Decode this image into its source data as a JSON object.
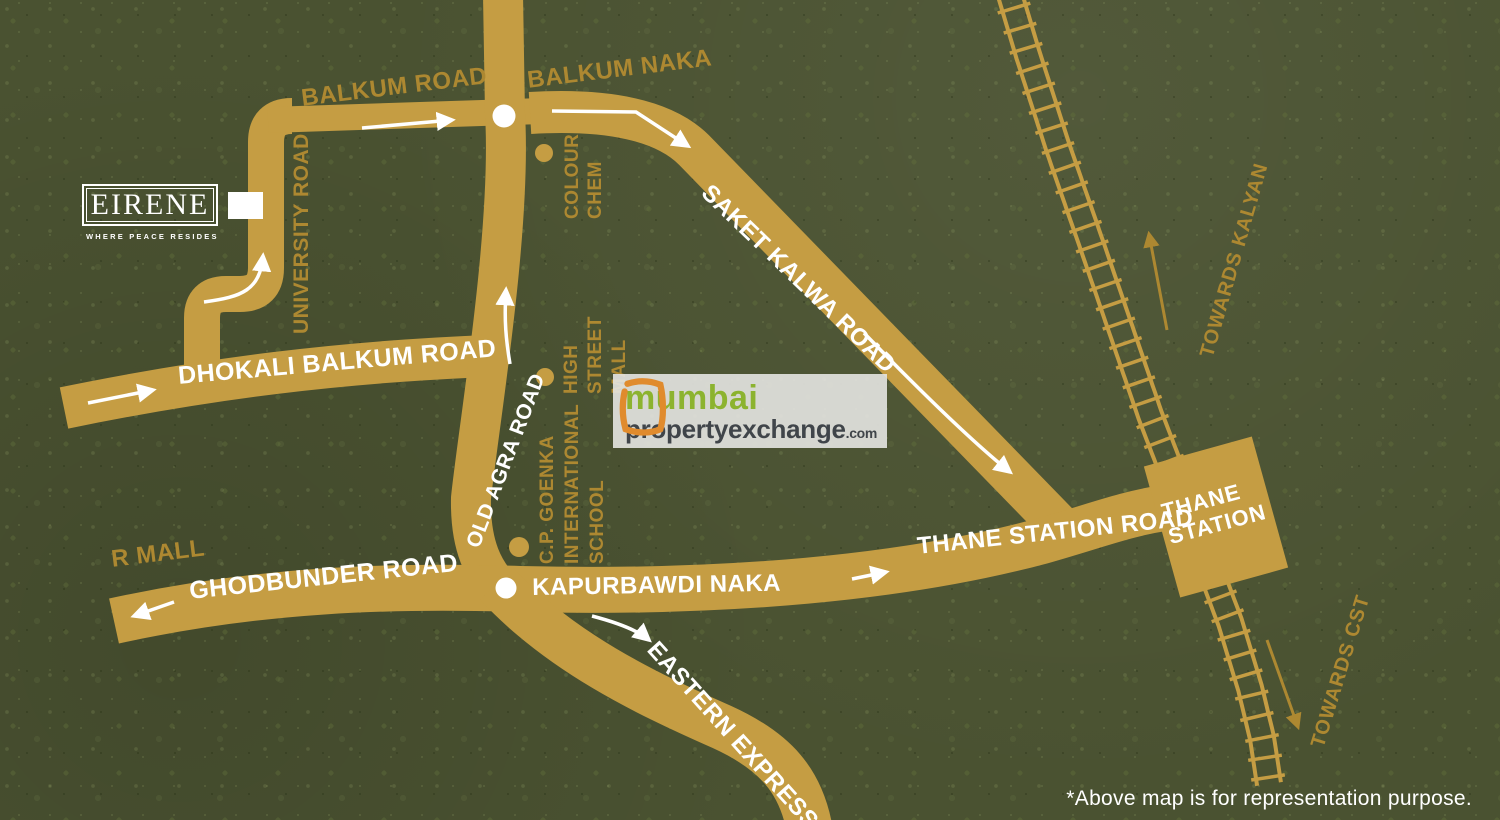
{
  "map": {
    "project": {
      "name": "EIRENE",
      "tagline": "WHERE PEACE RESIDES"
    },
    "roads": {
      "balkum_road": "BALKUM ROAD",
      "balkum_naka": "BALKUM NAKA",
      "university_road": "UNIVERSITY ROAD",
      "dhokali_balkum_road": "DHOKALI BALKUM ROAD",
      "old_agra_road": "OLD AGRA ROAD",
      "saket_kalwa_road": "SAKET KALWA ROAD",
      "ghodbunder_road": "GHODBUNDER ROAD",
      "kapurbawdi_naka": "KAPURBAWDI NAKA",
      "thane_station_road": "THANE STATION ROAD",
      "eastern_express_highway": "EASTERN EXPRESS H"
    },
    "landmarks": {
      "colour_chem": {
        "lines": [
          "COLOUR",
          "CHEM"
        ]
      },
      "high_street_mall": {
        "lines": [
          "HIGH",
          "STREET",
          "MALL"
        ]
      },
      "cp_goenka_school": {
        "lines": [
          "C.P. GOENKA",
          "INTERNATIONAL",
          "SCHOOL"
        ]
      },
      "r_mall": "R MALL"
    },
    "station": {
      "line1": "THANE",
      "line2": "STATION"
    },
    "directions": {
      "towards_kalyan": "TOWARDS KALYAN",
      "towards_cst": "TOWARDS CST"
    },
    "watermark": {
      "city": "mumbai",
      "brand": "propertyexchange",
      "tld": ".com"
    },
    "footnote": "*Above map is for representation purpose.",
    "colors": {
      "background": "#4a5231",
      "road": "#c59d43",
      "gold_text": "#ad8831",
      "white": "#ffffff",
      "watermark_green": "#8cb32f",
      "watermark_gray": "#40454a",
      "watermark_orange": "#e08b2d"
    }
  }
}
